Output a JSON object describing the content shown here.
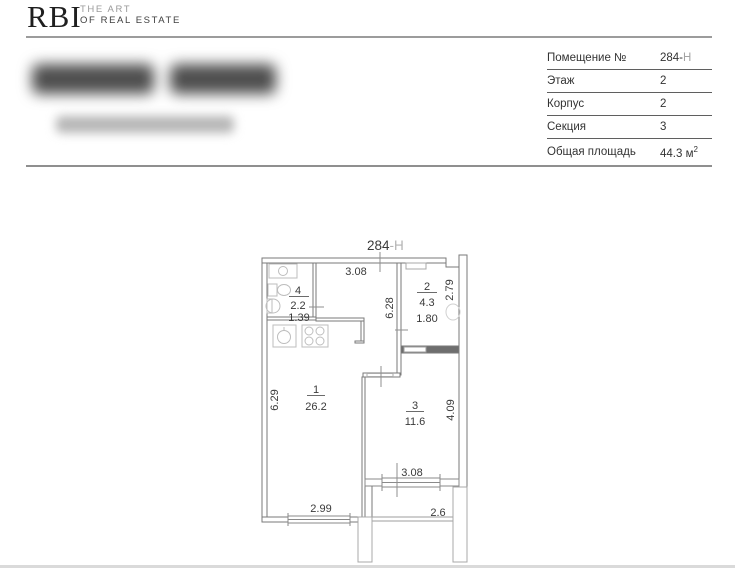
{
  "header": {
    "logo_text": "RBI",
    "tagline_line1": "THE ART",
    "tagline_line2": "OF REAL ESTATE"
  },
  "info_table": {
    "rows": [
      {
        "label": "Помещение №",
        "value_main": "284-",
        "value_suffix": "Н"
      },
      {
        "label": "Этаж",
        "value_main": "2"
      },
      {
        "label": "Корпус",
        "value_main": "2"
      },
      {
        "label": "Секция",
        "value_main": "3"
      },
      {
        "label": "Общая площадь",
        "value_main": "44.3 м",
        "value_sup": "2"
      }
    ]
  },
  "plan": {
    "unit_number": "284",
    "unit_suffix": "-Н",
    "rooms": {
      "room1": {
        "number": "1",
        "area": "26.2"
      },
      "room2": {
        "number": "2",
        "area": "4.3",
        "width": "1.80"
      },
      "room3": {
        "number": "3",
        "area": "11.6"
      },
      "room4": {
        "number": "4",
        "area": "2.2",
        "width": "1.39"
      }
    },
    "dimensions": {
      "top_width": "3.08",
      "hall_depth": "6.28",
      "room2_depth": "2.79",
      "room1_depth": "6.29",
      "room3_depth": "4.09",
      "balcony_opening": "3.08",
      "room1_width": "2.99",
      "balcony_width": "2.6"
    }
  },
  "colors": {
    "wall_line": "#7a7a7a",
    "wall_dark": "#666666",
    "plan_text": "#3a3a3a",
    "muted_text": "#9a9a9a",
    "fixture_line": "#bdbdbd"
  }
}
